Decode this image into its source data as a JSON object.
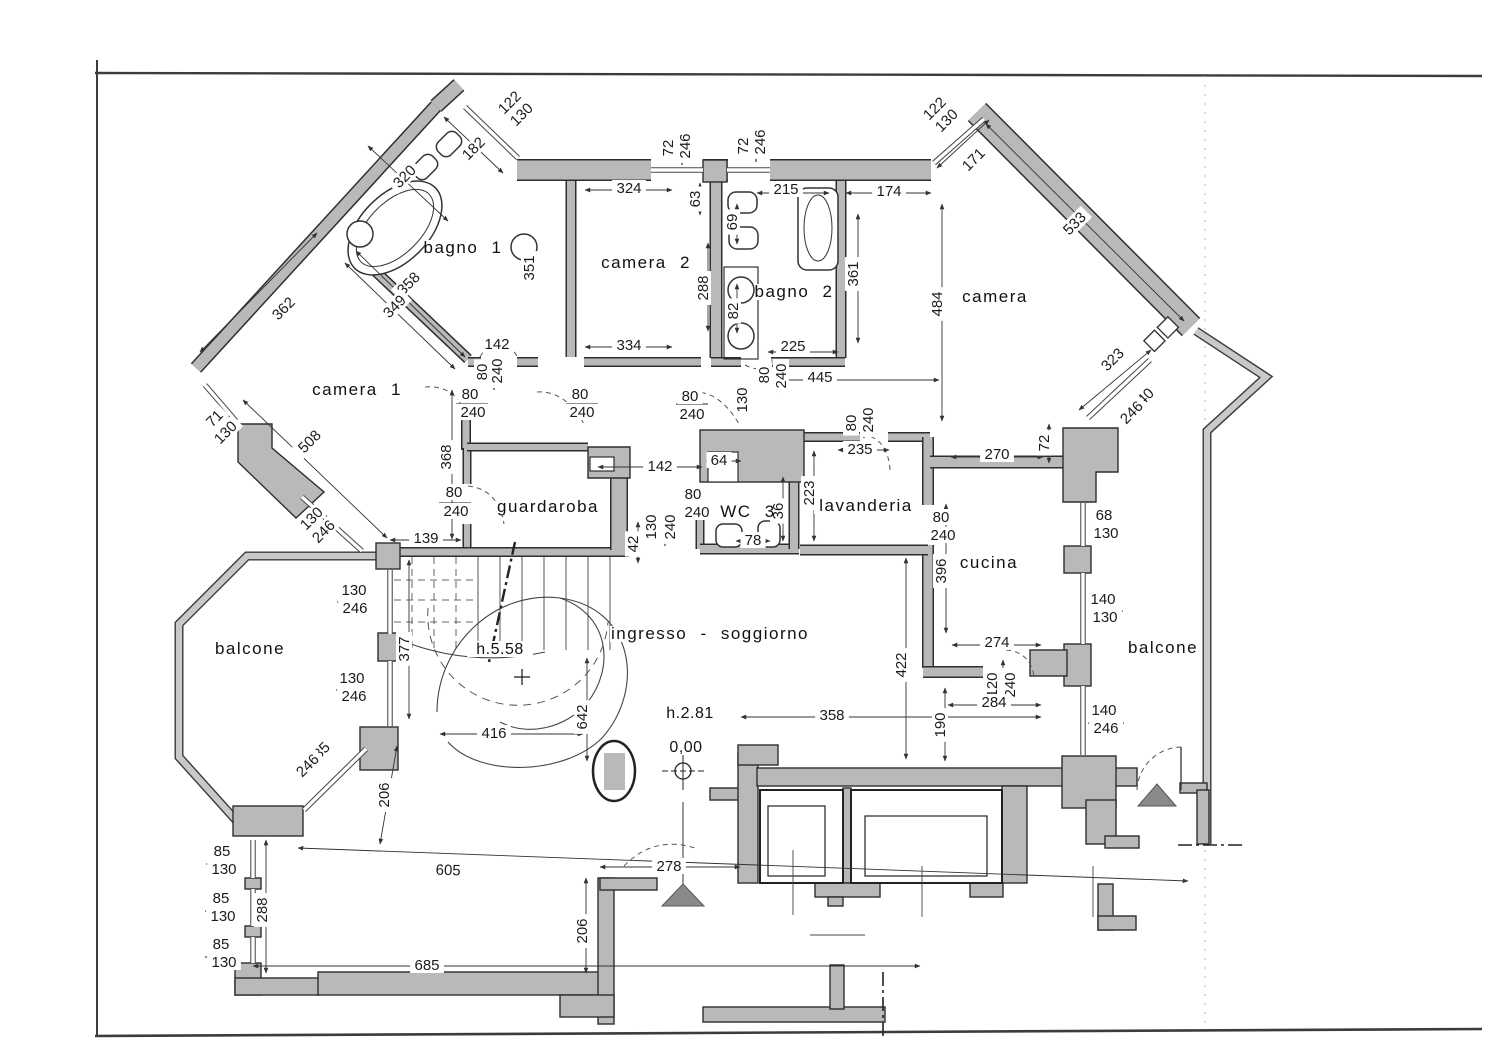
{
  "document": {
    "kind": "apartment floor plan (scanned architectural drawing)",
    "language": "Italian"
  },
  "colors": {
    "wall_fill": "#b9b9b9",
    "wall_edge": "#2e2e2e",
    "balcony_band": "#c9c9c9",
    "line": "#3a3a3a",
    "entrance_triangle": "#8a8a8a",
    "paper": "#ffffff"
  },
  "rooms": [
    {
      "text": "bagno 1",
      "x": 463,
      "y": 253
    },
    {
      "text": "camera 2",
      "x": 646,
      "y": 268
    },
    {
      "text": "bagno 2",
      "x": 794,
      "y": 297
    },
    {
      "text": "camera",
      "x": 995,
      "y": 302
    },
    {
      "text": "camera 1",
      "x": 357,
      "y": 395
    },
    {
      "text": "guardaroba",
      "x": 548,
      "y": 512
    },
    {
      "text": "WC 3",
      "x": 748,
      "y": 517
    },
    {
      "text": "lavanderia",
      "x": 866,
      "y": 511
    },
    {
      "text": "cucina",
      "x": 989,
      "y": 568
    },
    {
      "text": "balcone",
      "x": 250,
      "y": 654
    },
    {
      "text": "balcone",
      "x": 1163,
      "y": 653
    },
    {
      "text": "ingresso - soggiorno",
      "x": 710,
      "y": 639
    }
  ],
  "annotations": [
    {
      "text": "h.5.58",
      "x": 500,
      "y": 654
    },
    {
      "text": "h.2.81",
      "x": 690,
      "y": 718
    },
    {
      "text": "0,00",
      "x": 686,
      "y": 752
    }
  ],
  "dimensions": [
    {
      "text": "122",
      "x": 513,
      "y": 106,
      "r": -45
    },
    {
      "text": "130",
      "x": 525,
      "y": 118,
      "r": -45
    },
    {
      "text": "182",
      "x": 477,
      "y": 152,
      "r": -45
    },
    {
      "text": "320",
      "x": 408,
      "y": 180,
      "r": -45
    },
    {
      "text": "358",
      "x": 412,
      "y": 287,
      "r": -45
    },
    {
      "text": "349",
      "x": 398,
      "y": 310,
      "r": -45
    },
    {
      "text": "362",
      "x": 287,
      "y": 312,
      "r": -45
    },
    {
      "text": "351",
      "x": 534,
      "y": 268,
      "r": -90
    },
    {
      "text": "324",
      "x": 629,
      "y": 193
    },
    {
      "text": "72",
      "x": 673,
      "y": 148,
      "r": -90
    },
    {
      "text": "246",
      "x": 690,
      "y": 146,
      "r": -90
    },
    {
      "text": "63",
      "x": 700,
      "y": 199,
      "r": -90
    },
    {
      "text": "288",
      "x": 708,
      "y": 288,
      "r": -90
    },
    {
      "text": "334",
      "x": 629,
      "y": 350
    },
    {
      "text": "72",
      "x": 748,
      "y": 146,
      "r": -90
    },
    {
      "text": "246",
      "x": 765,
      "y": 142,
      "r": -90
    },
    {
      "text": "215",
      "x": 786,
      "y": 194
    },
    {
      "text": "174",
      "x": 889,
      "y": 196
    },
    {
      "text": "171",
      "x": 977,
      "y": 163,
      "r": -45
    },
    {
      "text": "122",
      "x": 938,
      "y": 112,
      "r": -45
    },
    {
      "text": "130",
      "x": 950,
      "y": 124,
      "r": -45
    },
    {
      "text": "69",
      "x": 737,
      "y": 222,
      "r": -90
    },
    {
      "text": "82",
      "x": 738,
      "y": 311,
      "r": -90
    },
    {
      "text": "361",
      "x": 858,
      "y": 274,
      "r": -90
    },
    {
      "text": "484",
      "x": 942,
      "y": 304,
      "r": -90
    },
    {
      "text": "533",
      "x": 1078,
      "y": 227,
      "r": -45
    },
    {
      "text": "225",
      "x": 793,
      "y": 351
    },
    {
      "text": "445",
      "x": 820,
      "y": 382
    },
    {
      "text": "80",
      "x": 769,
      "y": 375,
      "r": -90
    },
    {
      "text": "240",
      "x": 786,
      "y": 376,
      "r": -90
    },
    {
      "text": "130",
      "x": 747,
      "y": 400,
      "r": -90
    },
    {
      "text": "71",
      "x": 218,
      "y": 422,
      "r": -45
    },
    {
      "text": "130",
      "x": 229,
      "y": 436,
      "r": -45
    },
    {
      "text": "508",
      "x": 313,
      "y": 445,
      "r": -45
    },
    {
      "text": "130",
      "x": 315,
      "y": 522,
      "r": -45
    },
    {
      "text": "246",
      "x": 327,
      "y": 535,
      "r": -45
    },
    {
      "text": "368",
      "x": 451,
      "y": 457,
      "r": -90
    },
    {
      "text": "142",
      "x": 497,
      "y": 349
    },
    {
      "text": "80",
      "x": 487,
      "y": 372,
      "r": -90
    },
    {
      "text": "240",
      "x": 502,
      "y": 371,
      "r": -90
    },
    {
      "text": "80",
      "x": 470,
      "y": 399
    },
    {
      "text": "240",
      "x": 473,
      "y": 417
    },
    {
      "text": "80",
      "x": 580,
      "y": 399
    },
    {
      "text": "240",
      "x": 582,
      "y": 417
    },
    {
      "text": "80",
      "x": 690,
      "y": 401
    },
    {
      "text": "240",
      "x": 692,
      "y": 419
    },
    {
      "text": "139",
      "x": 426,
      "y": 543
    },
    {
      "text": "80",
      "x": 454,
      "y": 497
    },
    {
      "text": "240",
      "x": 456,
      "y": 516
    },
    {
      "text": "142",
      "x": 660,
      "y": 471
    },
    {
      "text": "64",
      "x": 719,
      "y": 465
    },
    {
      "text": "80",
      "x": 693,
      "y": 499
    },
    {
      "text": "240",
      "x": 697,
      "y": 517
    },
    {
      "text": "36",
      "x": 783,
      "y": 511,
      "r": -90
    },
    {
      "text": "78",
      "x": 753,
      "y": 545
    },
    {
      "text": "130",
      "x": 656,
      "y": 527,
      "r": -90
    },
    {
      "text": "240",
      "x": 675,
      "y": 527,
      "r": -90
    },
    {
      "text": "42",
      "x": 638,
      "y": 544,
      "r": -90
    },
    {
      "text": "223",
      "x": 814,
      "y": 493,
      "r": -90
    },
    {
      "text": "235",
      "x": 860,
      "y": 454
    },
    {
      "text": "80",
      "x": 856,
      "y": 423,
      "r": -90
    },
    {
      "text": "240",
      "x": 873,
      "y": 420,
      "r": -90
    },
    {
      "text": "270",
      "x": 997,
      "y": 459
    },
    {
      "text": "72",
      "x": 1049,
      "y": 443,
      "r": -90
    },
    {
      "text": "80",
      "x": 941,
      "y": 522
    },
    {
      "text": "240",
      "x": 943,
      "y": 540
    },
    {
      "text": "396",
      "x": 946,
      "y": 571,
      "r": -90
    },
    {
      "text": "68",
      "x": 1104,
      "y": 520
    },
    {
      "text": "130",
      "x": 1106,
      "y": 538
    },
    {
      "text": "140",
      "x": 1103,
      "y": 604
    },
    {
      "text": "130",
      "x": 1105,
      "y": 622
    },
    {
      "text": "274",
      "x": 997,
      "y": 647
    },
    {
      "text": "120",
      "x": 997,
      "y": 685,
      "r": -90
    },
    {
      "text": "240",
      "x": 1015,
      "y": 685,
      "r": -90
    },
    {
      "text": "284",
      "x": 994,
      "y": 707
    },
    {
      "text": "190",
      "x": 945,
      "y": 725,
      "r": -90
    },
    {
      "text": "422",
      "x": 906,
      "y": 665,
      "r": -90
    },
    {
      "text": "140",
      "x": 1104,
      "y": 715
    },
    {
      "text": "246",
      "x": 1106,
      "y": 733
    },
    {
      "text": "323",
      "x": 1116,
      "y": 363,
      "r": -45
    },
    {
      "text": "140",
      "x": 1146,
      "y": 403,
      "r": -45
    },
    {
      "text": "246",
      "x": 1135,
      "y": 416,
      "r": -45
    },
    {
      "text": "130",
      "x": 354,
      "y": 595
    },
    {
      "text": "246",
      "x": 355,
      "y": 613
    },
    {
      "text": "377",
      "x": 409,
      "y": 649,
      "r": -90
    },
    {
      "text": "130",
      "x": 352,
      "y": 683
    },
    {
      "text": "246",
      "x": 354,
      "y": 701
    },
    {
      "text": "185",
      "x": 322,
      "y": 757,
      "r": -45
    },
    {
      "text": "246",
      "x": 311,
      "y": 769,
      "r": -45
    },
    {
      "text": "206",
      "x": 389,
      "y": 795,
      "r": -90
    },
    {
      "text": "416",
      "x": 494,
      "y": 738
    },
    {
      "text": "642",
      "x": 587,
      "y": 717,
      "r": -90
    },
    {
      "text": "358",
      "x": 832,
      "y": 720
    },
    {
      "text": "278",
      "x": 669,
      "y": 871
    },
    {
      "text": "85",
      "x": 222,
      "y": 856
    },
    {
      "text": "130",
      "x": 224,
      "y": 874
    },
    {
      "text": "85",
      "x": 221,
      "y": 903
    },
    {
      "text": "130",
      "x": 223,
      "y": 921
    },
    {
      "text": "85",
      "x": 221,
      "y": 949
    },
    {
      "text": "130",
      "x": 224,
      "y": 967
    },
    {
      "text": "288",
      "x": 267,
      "y": 910,
      "r": -90
    },
    {
      "text": "605",
      "x": 448,
      "y": 875,
      "r": 2
    },
    {
      "text": "685",
      "x": 427,
      "y": 970
    },
    {
      "text": "206",
      "x": 587,
      "y": 931,
      "r": -90
    }
  ]
}
